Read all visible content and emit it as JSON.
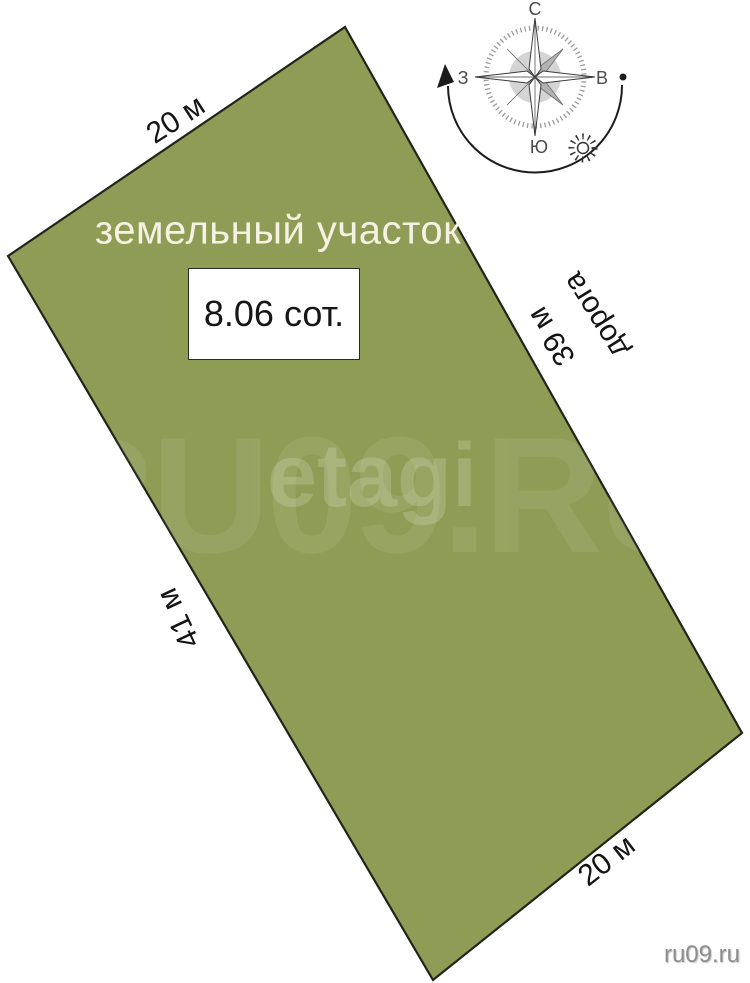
{
  "diagram": {
    "title": "земельный участок",
    "area": "8.06 сот.",
    "fill_color": "#8f9c55",
    "border_color": "#22241a"
  },
  "dimensions": {
    "top_edge": "20 м",
    "left_edge": "41 м",
    "right_edge": "39 м",
    "bottom_edge": "20 м",
    "road": "дорога"
  },
  "compass": {
    "north": "С",
    "south": "Ю",
    "west": "З",
    "east": "В"
  },
  "watermarks": {
    "brand": "etagi",
    "site_large": "RU09.RU",
    "site_corner": "ru09.ru"
  }
}
